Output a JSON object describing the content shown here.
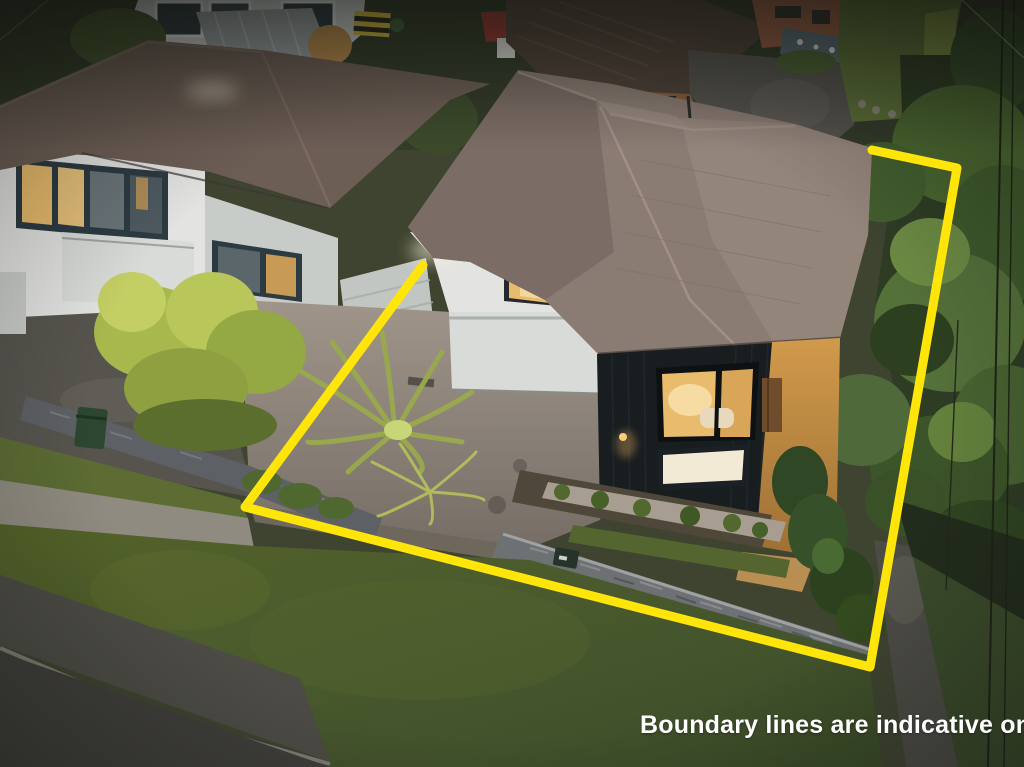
{
  "scene": {
    "type": "aerial-photograph",
    "time_of_day": "dusk",
    "subject": "residential property with marked boundary"
  },
  "caption": {
    "text": "Boundary lines are indicative only",
    "color": "#ffffff",
    "font_weight": "bold"
  },
  "boundary": {
    "points": "423,265 245,507 870,667 957,168 872,150",
    "color": "#ffe50a",
    "stroke_width": "9",
    "style": "solid"
  },
  "palette": {
    "roof_main": "#8b7c73",
    "roof_main_dark": "#7b6d65",
    "roof_main_light": "#94857b",
    "roof_left": "#6d5e55",
    "roof_back": "#4f4239",
    "wall_white": "#e3e4e1",
    "garage_white": "#d8dbd8",
    "black_cladding": "#181d20",
    "window_amber": "#e9bc6d",
    "window_amber_bright": "#f3d89e",
    "driveway_concrete": "#8f877c",
    "asphalt": "#55524c",
    "lawn_front": "#4c5c2f",
    "lawn_verge": "#5c6c33",
    "lawn_back": "#5d7038",
    "trees_green": "#3f5a2c",
    "hedge_bright": "#7d9141",
    "stone_wall": "#6e7173",
    "stone_wall_left": "#5d6064",
    "warm_path": "#c08944",
    "footpath": "#4c4b45",
    "road": "#3f3e3a",
    "shed_red": "#93392e",
    "foliage_lime": "#a9b84d"
  }
}
